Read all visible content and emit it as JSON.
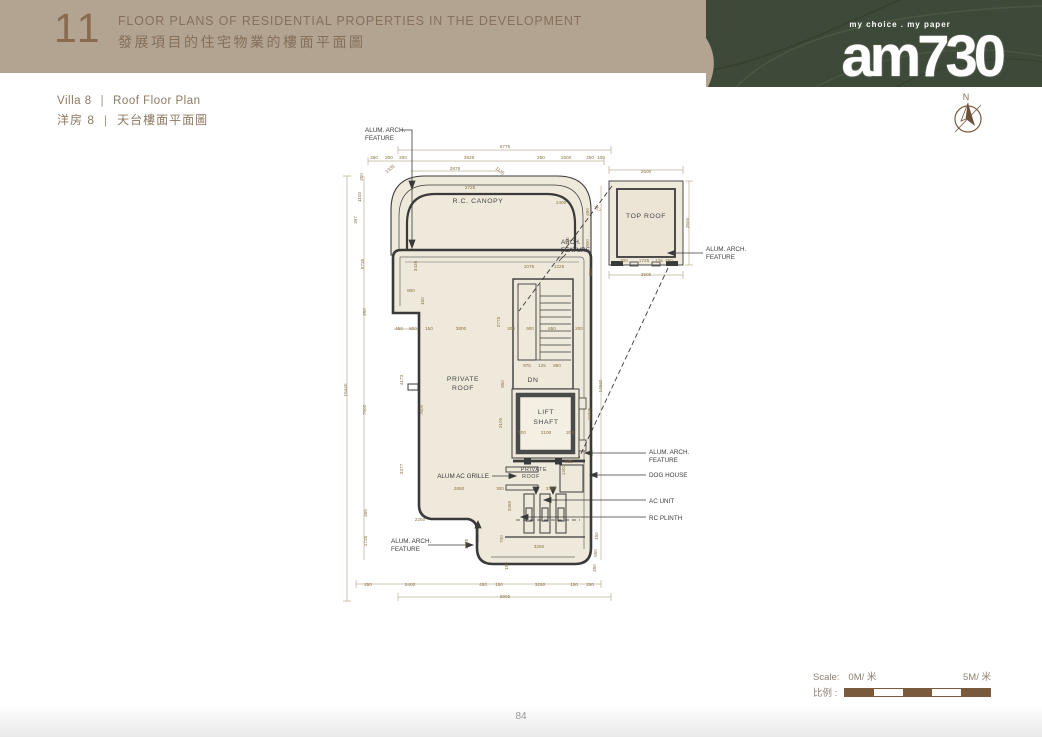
{
  "header": {
    "section_number": "11",
    "title_en": "FLOOR PLANS OF RESIDENTIAL PROPERTIES IN THE DEVELOPMENT",
    "title_zh": "發展項目的住宅物業的樓面平面圖"
  },
  "subtitle": {
    "villa_en": "Villa 8",
    "villa_zh": "洋房 8",
    "sep": "|",
    "plan_en": "Roof Floor Plan",
    "plan_zh": "天台樓面平面圖"
  },
  "logo": {
    "tagline": "my choice . my paper",
    "name": "am730"
  },
  "compass": {
    "label": "N"
  },
  "scale_bar": {
    "label_en": "Scale:",
    "start": "0M/ 米",
    "end": "5M/ 米",
    "label_zh": "比例 :"
  },
  "footer": {
    "page_number": "84"
  },
  "colors": {
    "band": "#b3a492",
    "green_block": "#3e4a39",
    "brown_text": "#87705a",
    "dim_text": "#8a7347",
    "wall": "#3a3a3a",
    "plan_fill": "#efe9dc",
    "scale_brown": "#7a5a3c"
  },
  "plan": {
    "rooms": [
      {
        "t": "R.C. CANOPY",
        "x": 478,
        "y": 203
      },
      {
        "t": "PRIVATE",
        "x": 463,
        "y": 381
      },
      {
        "t": "ROOF",
        "x": 463,
        "y": 390
      },
      {
        "t": "DN",
        "x": 533,
        "y": 382
      },
      {
        "t": "LIFT",
        "x": 546,
        "y": 414
      },
      {
        "t": "SHAFT",
        "x": 546,
        "y": 424
      },
      {
        "t": "PRIVATE",
        "x": 534,
        "y": 471,
        "s": 5.4
      },
      {
        "t": "ROOF",
        "x": 531,
        "y": 478,
        "s": 5.4
      },
      {
        "t": "TOP ROOF",
        "x": 646,
        "y": 218
      }
    ],
    "callouts": [
      {
        "t": "ALUM. ARCH.",
        "x": 365,
        "y": 132,
        "a": "start"
      },
      {
        "t": "FEATURE",
        "x": 365,
        "y": 140,
        "a": "start"
      },
      {
        "t": "ARCH.",
        "x": 561,
        "y": 244,
        "a": "start"
      },
      {
        "t": "FEATURE",
        "x": 561,
        "y": 252,
        "a": "start"
      },
      {
        "t": "ALUM. ARCH.",
        "x": 706,
        "y": 251,
        "a": "start"
      },
      {
        "t": "FEATURE",
        "x": 706,
        "y": 259,
        "a": "start"
      },
      {
        "t": "ALUM AC GRILLE",
        "x": 489,
        "y": 478,
        "a": "end"
      },
      {
        "t": "ALUM. ARCH.",
        "x": 649,
        "y": 454,
        "a": "start"
      },
      {
        "t": "FEATURE",
        "x": 649,
        "y": 462,
        "a": "start"
      },
      {
        "t": "DOG HOUSE",
        "x": 649,
        "y": 477,
        "a": "start"
      },
      {
        "t": "AC UNIT",
        "x": 649,
        "y": 503,
        "a": "start"
      },
      {
        "t": "RC PLINTH",
        "x": 649,
        "y": 520,
        "a": "start"
      },
      {
        "t": "ALUM. ARCH.",
        "x": 391,
        "y": 543,
        "a": "start"
      },
      {
        "t": "FEATURE",
        "x": 391,
        "y": 551,
        "a": "start"
      }
    ],
    "dims": [
      {
        "t": "6775",
        "x": 505,
        "y": 148
      },
      {
        "t": "250",
        "x": 374,
        "y": 159
      },
      {
        "t": "200",
        "x": 389,
        "y": 159
      },
      {
        "t": "200",
        "x": 403,
        "y": 159
      },
      {
        "t": "3925",
        "x": 469,
        "y": 159
      },
      {
        "t": "250",
        "x": 541,
        "y": 159
      },
      {
        "t": "1600",
        "x": 566,
        "y": 159
      },
      {
        "t": "250",
        "x": 590,
        "y": 159
      },
      {
        "t": "100",
        "x": 601,
        "y": 159
      },
      {
        "t": "2875",
        "x": 455,
        "y": 170
      },
      {
        "t": "2725",
        "x": 470,
        "y": 189
      },
      {
        "t": "1400",
        "x": 561,
        "y": 204
      },
      {
        "t": "1335",
        "x": 391,
        "y": 170,
        "r": -40
      },
      {
        "t": "1135",
        "x": 499,
        "y": 172,
        "r": 40
      },
      {
        "t": "767",
        "x": 596,
        "y": 209,
        "r": 55
      },
      {
        "t": "250",
        "x": 363,
        "y": 177,
        "r": -90
      },
      {
        "t": "1103",
        "x": 361,
        "y": 197,
        "r": -90
      },
      {
        "t": "397",
        "x": 357,
        "y": 220,
        "r": -90
      },
      {
        "t": "15440",
        "x": 347,
        "y": 390,
        "r": -90
      },
      {
        "t": "5735",
        "x": 364,
        "y": 264,
        "r": -90
      },
      {
        "t": "250",
        "x": 366,
        "y": 312,
        "r": -90
      },
      {
        "t": "7500",
        "x": 366,
        "y": 410,
        "r": -90
      },
      {
        "t": "455",
        "x": 367,
        "y": 513,
        "r": -90
      },
      {
        "t": "1725",
        "x": 367,
        "y": 541,
        "r": -90
      },
      {
        "t": "3435",
        "x": 417,
        "y": 266,
        "r": -90
      },
      {
        "t": "800",
        "x": 411,
        "y": 292
      },
      {
        "t": "150",
        "x": 424,
        "y": 301,
        "r": -90
      },
      {
        "t": "450",
        "x": 399,
        "y": 330
      },
      {
        "t": "800",
        "x": 413,
        "y": 330
      },
      {
        "t": "150",
        "x": 429,
        "y": 330
      },
      {
        "t": "4173",
        "x": 403,
        "y": 380,
        "r": -90
      },
      {
        "t": "7600",
        "x": 423,
        "y": 410,
        "r": -90
      },
      {
        "t": "3377",
        "x": 403,
        "y": 469,
        "r": -90
      },
      {
        "t": "2250",
        "x": 420,
        "y": 521
      },
      {
        "t": "1725",
        "x": 468,
        "y": 544,
        "r": -90
      },
      {
        "t": "450",
        "x": 589,
        "y": 212,
        "r": -90
      },
      {
        "t": "900",
        "x": 589,
        "y": 243,
        "r": -90
      },
      {
        "t": "800",
        "x": 592,
        "y": 272,
        "r": -90
      },
      {
        "t": "150",
        "x": 569,
        "y": 241,
        "r": -90
      },
      {
        "t": "1075",
        "x": 529,
        "y": 268
      },
      {
        "t": "1225",
        "x": 559,
        "y": 268
      },
      {
        "t": "3800",
        "x": 461,
        "y": 330
      },
      {
        "t": "2775",
        "x": 500,
        "y": 322,
        "r": -90
      },
      {
        "t": "200",
        "x": 511,
        "y": 330
      },
      {
        "t": "900",
        "x": 530,
        "y": 330
      },
      {
        "t": "650",
        "x": 552,
        "y": 330
      },
      {
        "t": "200",
        "x": 579,
        "y": 330
      },
      {
        "t": "975",
        "x": 527,
        "y": 367
      },
      {
        "t": "125",
        "x": 542,
        "y": 367
      },
      {
        "t": "850",
        "x": 557,
        "y": 367
      },
      {
        "t": "950",
        "x": 504,
        "y": 384,
        "r": -90
      },
      {
        "t": "2100",
        "x": 502,
        "y": 423,
        "r": -90
      },
      {
        "t": "200",
        "x": 522,
        "y": 434
      },
      {
        "t": "2100",
        "x": 546,
        "y": 434
      },
      {
        "t": "200",
        "x": 570,
        "y": 434
      },
      {
        "t": "14560",
        "x": 602,
        "y": 386,
        "r": -90
      },
      {
        "t": "10225",
        "x": 591,
        "y": 414,
        "r": -90
      },
      {
        "t": "535",
        "x": 569,
        "y": 463
      },
      {
        "t": "1300",
        "x": 565,
        "y": 470,
        "r": -90
      },
      {
        "t": "2850",
        "x": 459,
        "y": 490
      },
      {
        "t": "300",
        "x": 500,
        "y": 490
      },
      {
        "t": "3350",
        "x": 551,
        "y": 490
      },
      {
        "t": "3350",
        "x": 511,
        "y": 506,
        "r": -90
      },
      {
        "t": "700",
        "x": 503,
        "y": 539,
        "r": -90
      },
      {
        "t": "150",
        "x": 508,
        "y": 566,
        "r": -90
      },
      {
        "t": "3250",
        "x": 539,
        "y": 548
      },
      {
        "t": "150",
        "x": 598,
        "y": 536,
        "r": -90
      },
      {
        "t": "550",
        "x": 597,
        "y": 553,
        "r": -90
      },
      {
        "t": "450",
        "x": 596,
        "y": 568,
        "r": -90
      },
      {
        "t": "250",
        "x": 368,
        "y": 586
      },
      {
        "t": "2400",
        "x": 410,
        "y": 586
      },
      {
        "t": "450",
        "x": 483,
        "y": 586
      },
      {
        "t": "150",
        "x": 499,
        "y": 586
      },
      {
        "t": "3250",
        "x": 540,
        "y": 586
      },
      {
        "t": "150",
        "x": 574,
        "y": 586
      },
      {
        "t": "250",
        "x": 590,
        "y": 586
      },
      {
        "t": "6900",
        "x": 505,
        "y": 598
      },
      {
        "t": "2500",
        "x": 646,
        "y": 173
      },
      {
        "t": "2600",
        "x": 689,
        "y": 223,
        "r": -90
      },
      {
        "t": "200",
        "x": 624,
        "y": 262
      },
      {
        "t": "1725",
        "x": 644,
        "y": 262
      },
      {
        "t": "125",
        "x": 659,
        "y": 262
      },
      {
        "t": "450",
        "x": 669,
        "y": 262
      },
      {
        "t": "2500",
        "x": 646,
        "y": 276
      }
    ]
  }
}
